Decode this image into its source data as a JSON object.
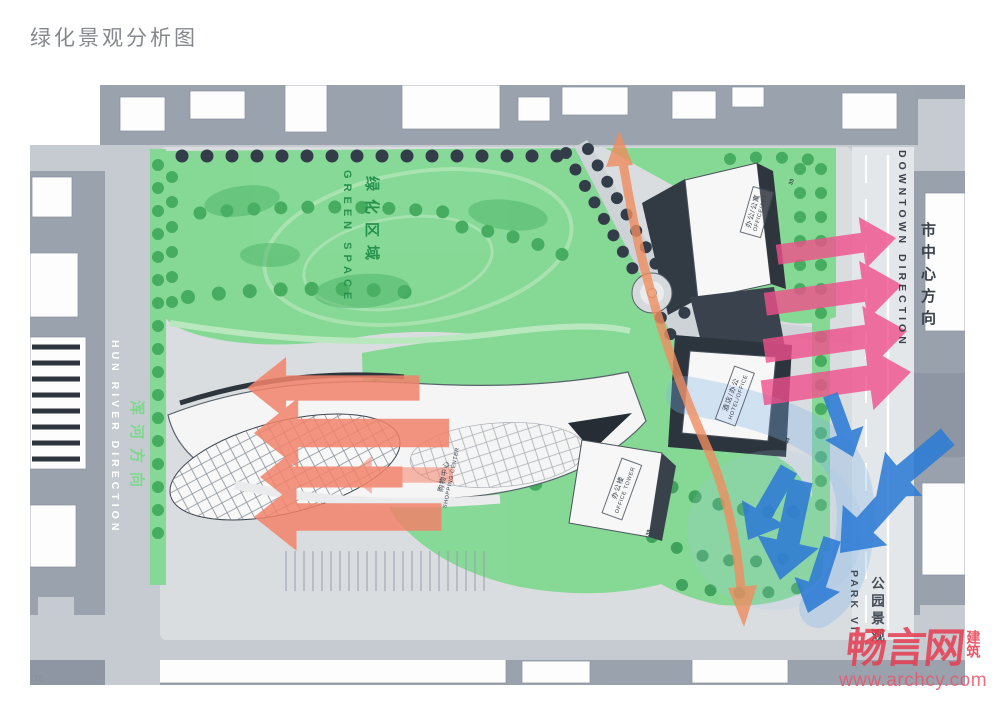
{
  "page": {
    "title": "绿化景观分析图",
    "page_number": "18"
  },
  "plan": {
    "area_labels": {
      "green_cn": "绿化区域",
      "green_en": "GREEN SPACE"
    },
    "direction_labels": {
      "hun_river_en": "HUN RIVER DIRECTION",
      "hun_river_cn": "浑河方向",
      "downtown_en": "DOWNTOWN DIRECTION",
      "downtown_cn": "市中心方向",
      "park_en": "PARK VI",
      "park_cn": "公园景观"
    },
    "buildings": {
      "office_apt": {
        "cn": "办公/公寓",
        "en": "OFFICE/APT",
        "num": "33"
      },
      "hotel_office": {
        "cn": "酒店/办公",
        "en": "HOTEL/OFFICE",
        "num": "44"
      },
      "office_tower": {
        "cn": "办公楼",
        "en": "OFFICE TOWER",
        "num": "39"
      },
      "shopping_center": {
        "cn": "购物中心",
        "en": "SHOPPING CENTER"
      }
    },
    "arrows": {
      "river_view": {
        "color": "#f2836b",
        "direction": "left",
        "count": 4
      },
      "downtown_view": {
        "color": "#f0508c",
        "direction": "right",
        "count": 4
      },
      "park_view": {
        "color": "#2e7cd6",
        "direction": "down-left",
        "count": 6
      },
      "green_axis": {
        "color": "#ef8d5f",
        "direction": "north-south-axis"
      }
    },
    "colors": {
      "green_space": "#82d892",
      "road": "#c6cbd1",
      "context_block": "#9aa2ae"
    }
  },
  "watermark": {
    "logo": "畅言网",
    "logo_side": "建筑",
    "url": "www.archcy.com"
  }
}
